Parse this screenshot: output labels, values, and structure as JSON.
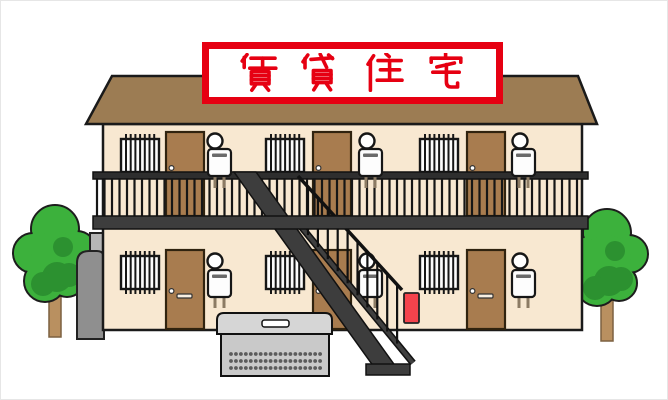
{
  "sign": {
    "text": "賃貸住宅",
    "characters": [
      "賃",
      "貸",
      "住",
      "宅"
    ],
    "text_color": "#e60012",
    "frame_color": "#e60012",
    "background_color": "#ffffff"
  },
  "illustration": {
    "type": "clipart",
    "subject": "two-story rental apartment building",
    "building": {
      "floors": 2,
      "units_per_floor": 3,
      "unit_elements": [
        "barred-window",
        "entry-door",
        "porch-light",
        "water-heater"
      ],
      "wall_color": "#f8e8d1",
      "roof_color": "#9c7c53",
      "door_color": "#a87c4f"
    },
    "features": [
      "balcony-railing",
      "external-staircase",
      "garbage-collection-box",
      "lp-gas-tank",
      "utility-panel",
      "fire-extinguisher-box",
      "tree-left",
      "tree-right"
    ],
    "accent_colors": {
      "railing_dark": "#3d3d3d",
      "fire_box_red": "#f4434c",
      "tree_green": "#3cb13c",
      "tree_green_dark": "#2c9130",
      "trunk_brown": "#b99060",
      "garbage_box_gray": "#c9c9c9"
    }
  }
}
